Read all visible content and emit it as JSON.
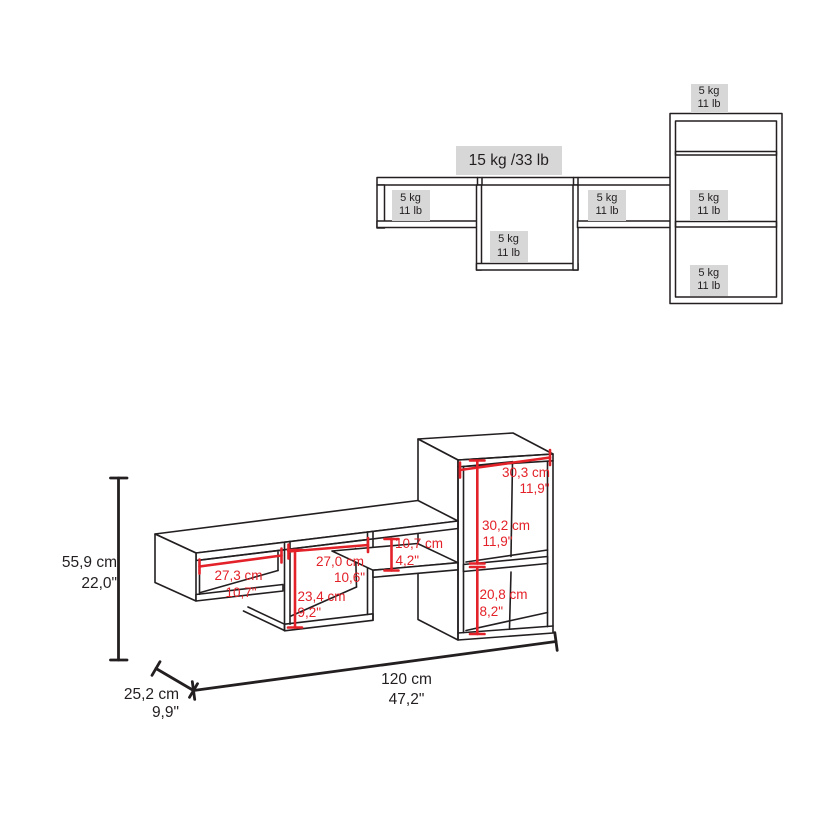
{
  "colors": {
    "line_dark": "#231f20",
    "dimension_red": "#e32128",
    "label_gray": "#d7d7d7",
    "background": "#ffffff"
  },
  "capacity_view": {
    "total_capacity_label": "15 kg /33 lb",
    "shelf_labels": [
      {
        "location": "left-compartment",
        "kg": "5 kg",
        "lb": "11 lb"
      },
      {
        "location": "center-cube",
        "kg": "5 kg",
        "lb": "11 lb"
      },
      {
        "location": "right-compartment",
        "kg": "5 kg",
        "lb": "11 lb"
      },
      {
        "location": "tall-unit-top",
        "kg": "5 kg",
        "lb": "11 lb"
      },
      {
        "location": "tall-unit-middle",
        "kg": "5 kg",
        "lb": "11 lb"
      },
      {
        "location": "tall-unit-bottom",
        "kg": "5 kg",
        "lb": "11 lb"
      }
    ]
  },
  "dimension_view": {
    "overall": {
      "height_cm": "55,9 cm",
      "height_in": "22,0\"",
      "width_cm": "120 cm",
      "width_in": "47,2\"",
      "depth_cm": "25,2 cm",
      "depth_in": "9,9\""
    },
    "parts": [
      {
        "name": "tall-unit-inner-width",
        "cm": "30,3 cm",
        "in": "11,9\""
      },
      {
        "name": "tall-unit-upper-height",
        "cm": "30,2 cm",
        "in": "11,9\""
      },
      {
        "name": "tall-unit-lower-height",
        "cm": "20,8 cm",
        "in": "8,2\""
      },
      {
        "name": "shelf-gap-height",
        "cm": "10,7 cm",
        "in": "4,2\""
      },
      {
        "name": "center-cube-width",
        "cm": "27,0 cm",
        "in": "10,6\""
      },
      {
        "name": "left-compartment-width",
        "cm": "27,3 cm",
        "in": "10,7\""
      },
      {
        "name": "center-cube-height",
        "cm": "23,4 cm",
        "in": "9,2\""
      }
    ]
  }
}
